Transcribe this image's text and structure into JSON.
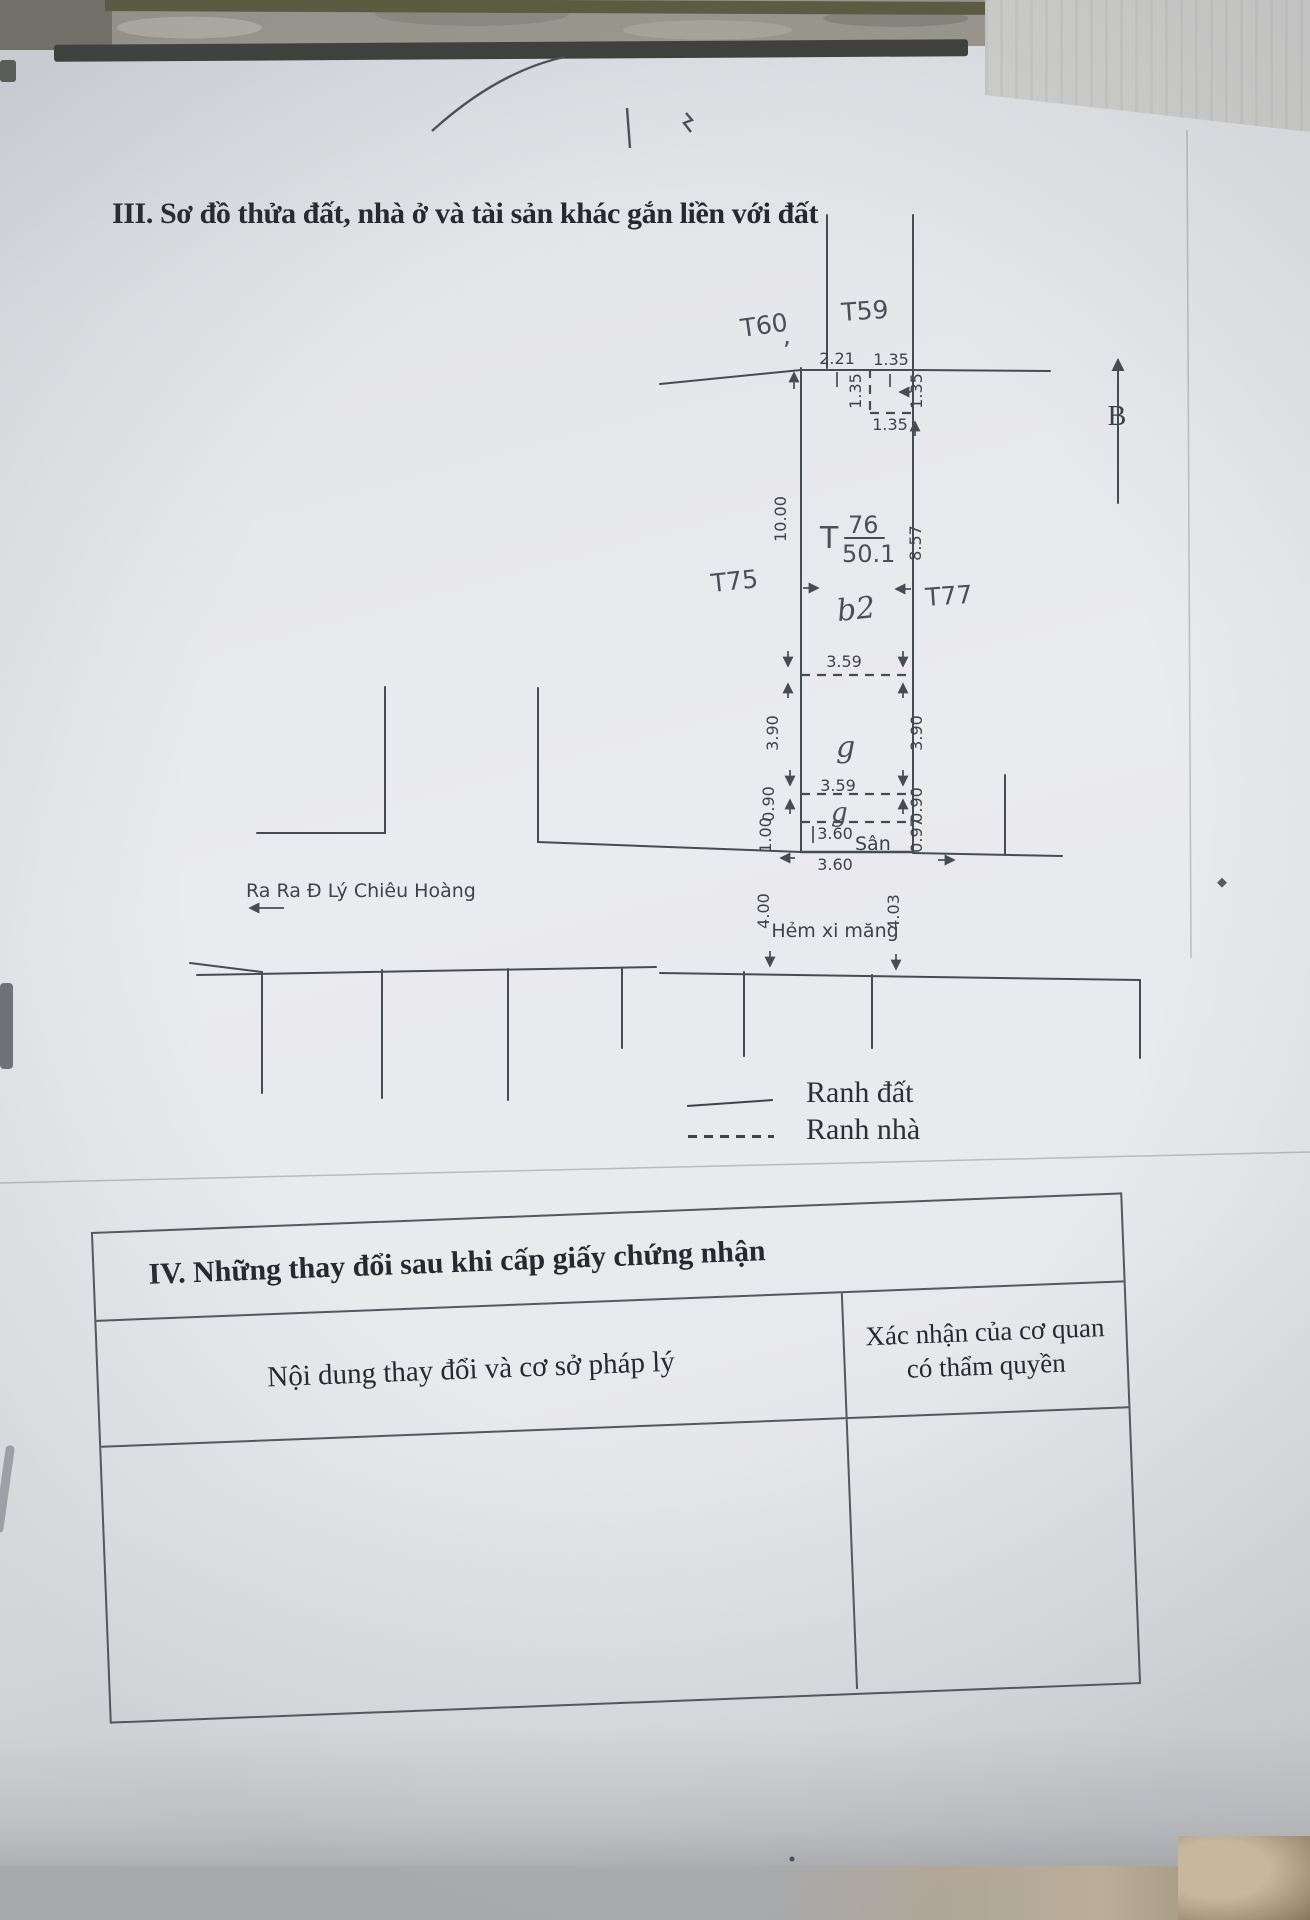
{
  "page": {
    "paper_color": "#e9eaee",
    "ink_color": "#3e434b",
    "text_color": "#26292e"
  },
  "section3": {
    "title": "III. Sơ đồ thửa đất, nhà ở và tài sản khác gắn liền với đất"
  },
  "diagram": {
    "north_label": "B",
    "street_note": "Ra Ra Đ Lý Chiêu Hoàng",
    "alley_name": "Hẻm xi măng",
    "plots": {
      "t60": "T60",
      "t60_comma": ",",
      "t59": "T59",
      "t75": "T75",
      "t77": "T77",
      "t76_label": "T",
      "t76_number": "76",
      "t76_area": "50.1",
      "house_label": "b2",
      "g_upper": "g",
      "g_lower": "g",
      "yard": "Sân"
    },
    "dims": {
      "top_left": "2.21",
      "top_right": "1.35",
      "notch_left": "1.35",
      "notch_right": "1.35",
      "notch_bottom": "1.35",
      "depth_left": "10.00",
      "depth_right": "8.57",
      "width_1": "3.59",
      "side_left_1": "3.90",
      "side_right_1": "3.90",
      "width_2": "3.59",
      "side_left_2": "0.90",
      "side_right_2": "0.90",
      "yard_left": "1.00",
      "yard_width": "3.60",
      "yard_right": "0.97",
      "bottom_width": "3.60",
      "alley_left": "4.00",
      "alley_right": "4.03"
    }
  },
  "legend": {
    "land_boundary": "Ranh đất",
    "house_boundary": "Ranh nhà"
  },
  "section4": {
    "title": "IV. Những thay đổi sau khi cấp giấy chứng nhận",
    "col_content": "Nội dung thay đổi và cơ sở pháp lý",
    "col_confirm_line1": "Xác nhận của cơ quan",
    "col_confirm_line2": "có thẩm quyền"
  }
}
